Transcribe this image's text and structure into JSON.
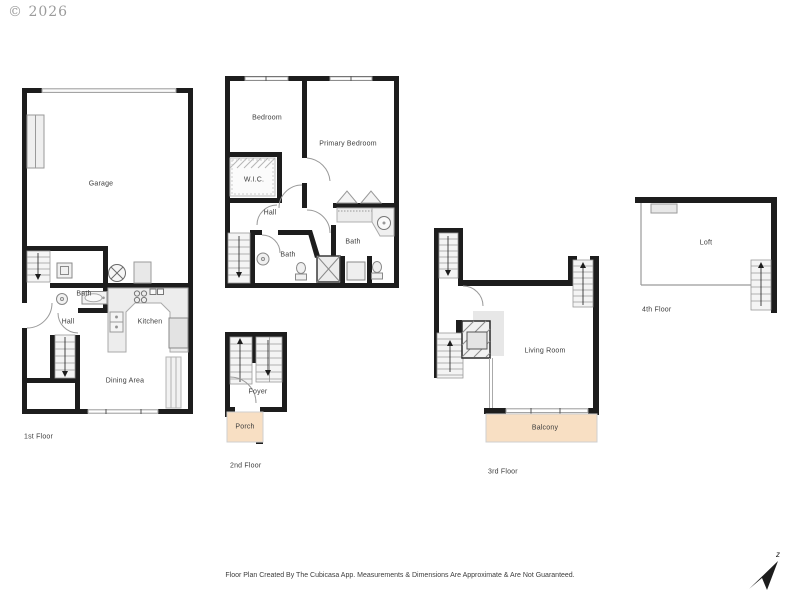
{
  "watermark": "© 2026",
  "floor1": {
    "label": "1st Floor",
    "garage": "Garage",
    "bath": "Bath",
    "hall": "Hall",
    "kitchen": "Kitchen",
    "dining_area": "Dining Area"
  },
  "floor2": {
    "label": "2nd Floor",
    "bedroom": "Bedroom",
    "primary_bedroom": "Primary Bedroom",
    "wic": "W.I.C.",
    "hall": "Hall",
    "bath_small": "Bath",
    "bath_main": "Bath",
    "foyer": "Foyer",
    "porch": "Porch"
  },
  "floor3": {
    "label": "3rd Floor",
    "living_room": "Living Room",
    "balcony": "Balcony"
  },
  "floor4": {
    "label": "4th Floor",
    "loft": "Loft"
  },
  "footer": {
    "disclaimer": "Floor Plan Created By The Cubicasa App. Measurements & Dimensions Are Approximate & Are Not Guaranteed."
  },
  "compass": {
    "north_label": "z"
  },
  "colors": {
    "wall": "#1d1d1d",
    "outdoor_fill": "#f8dfc3",
    "fixture_fill": "#ededed",
    "fixture_stroke": "#9a9a9a",
    "label_text": "#3c3c3c",
    "watermark_text": "#9b9b9b"
  }
}
